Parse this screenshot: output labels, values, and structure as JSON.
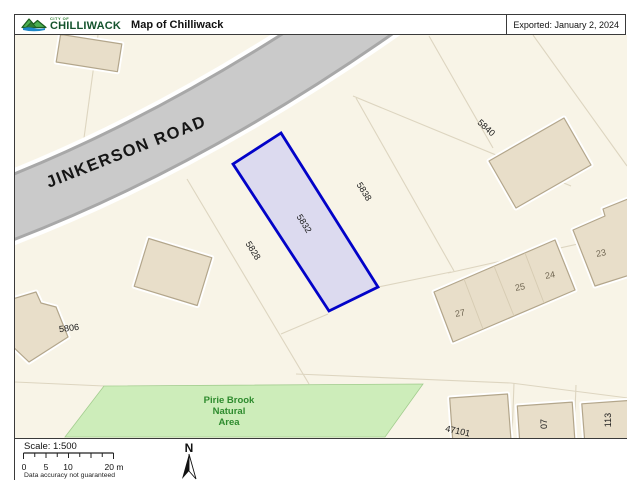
{
  "header": {
    "logo_small": "CITY OF",
    "logo_text": "CHILLIWACK",
    "title": "Map of Chilliwack",
    "exported": "Exported: January 2, 2024"
  },
  "map": {
    "road_label": "JINKERSON ROAD",
    "natural_area": {
      "line1": "Pirie Brook",
      "line2": "Natural",
      "line3": "Area"
    },
    "highlighted_parcel": "5832",
    "parcels": [
      {
        "label": "5806"
      },
      {
        "label": "5828"
      },
      {
        "label": "5832"
      },
      {
        "label": "5838"
      },
      {
        "label": "5840"
      },
      {
        "label": "47101"
      },
      {
        "label": "07"
      },
      {
        "label": "113"
      }
    ],
    "units": [
      {
        "label": "23"
      },
      {
        "label": "24"
      },
      {
        "label": "25"
      },
      {
        "label": "27"
      }
    ],
    "colors": {
      "highlight_border": "#0202c8",
      "highlight_fill": "#dcdaef",
      "road_fill": "#cacaca",
      "natural_area_fill": "#cdedba",
      "natural_area_text": "#2e8b2e",
      "building_fill": "#e8dec9",
      "map_background": "#f8f4e7"
    }
  },
  "footer": {
    "scale_label": "Scale: 1:500",
    "scale_ticks": [
      "0",
      "5",
      "10",
      "20 m"
    ],
    "disclaimer": "Data accuracy not guaranteed",
    "north": "N"
  }
}
